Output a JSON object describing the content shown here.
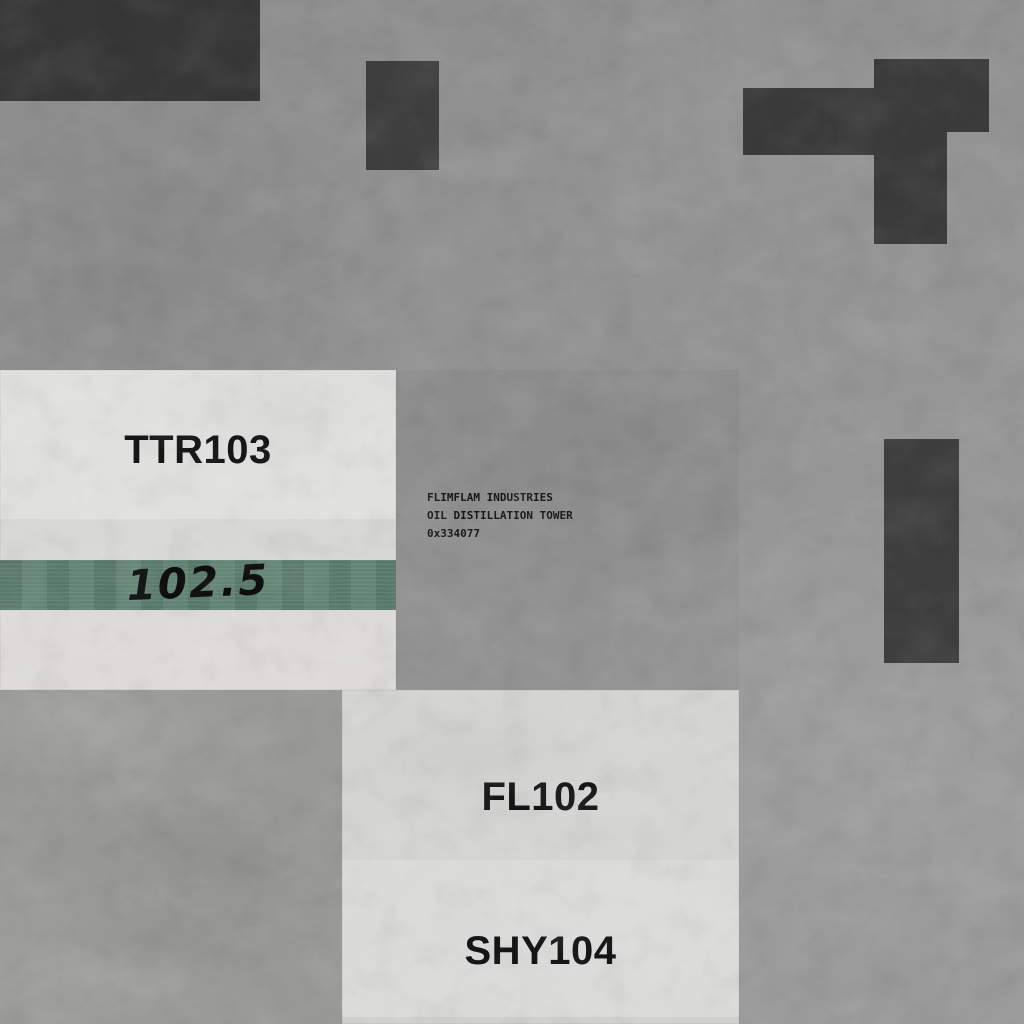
{
  "units": {
    "ttr103": {
      "label": "TTR103",
      "gauge_value": "102.5"
    },
    "fl102": {
      "label": "FL102"
    },
    "shy104": {
      "label": "SHY104"
    }
  },
  "plaque": {
    "line1": "FLIMFLAM INDUSTRIES",
    "line2": "OIL DISTILLATION TOWER",
    "line3": "0x334077"
  },
  "colors": {
    "floor_gray": "#959595",
    "slab_gray": "#999997",
    "panel_light": "#e0e0de",
    "panel_shade": "#d7d7d5",
    "green_band": "#5e8070",
    "dark_structure": "#3b3b3b",
    "ink": "#161616"
  }
}
